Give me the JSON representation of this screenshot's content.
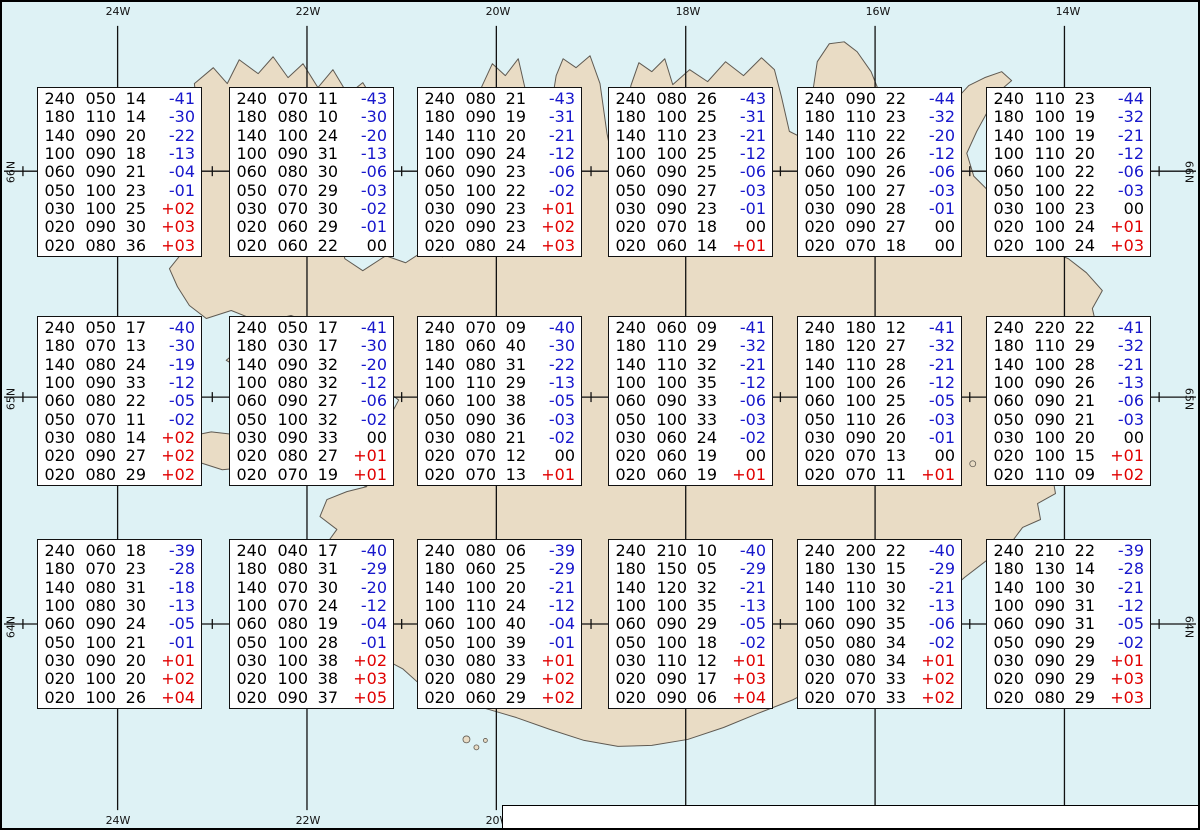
{
  "title": "Spot Chart Iceland",
  "axes": {
    "lon_labels": [
      "24W",
      "22W",
      "20W",
      "18W",
      "16W",
      "14W"
    ],
    "bottom_lon_labels": [
      "24W",
      "22W",
      "20W"
    ],
    "lat_labels": [
      "66N",
      "65N",
      "64N"
    ]
  },
  "footer": {
    "prefix": "Spot Chart: FL Dir KT °C ",
    "source_bold": "UWC/IG-IS:",
    "issue": " IT: Lau. 06. Des. 2025 15Z ",
    "valid_bold": "VT: Lau. 06.12.2025 23Z",
    "suffix": " (+8 h)"
  },
  "colors": {
    "water": "#def2f5",
    "land": "#e9dcc5",
    "coast": "#5f5a52",
    "grid": "#111111",
    "negative_temp": "#1717cc",
    "positive_temp": "#e00000",
    "neutral_temp": "#000000",
    "box_bg": "#ffffff",
    "box_border": "#111111"
  },
  "chart_data": {
    "type": "table",
    "columns": [
      "FL",
      "Dir",
      "KT",
      "°C"
    ],
    "description": "Upper-air spot values (flight level, wind direction deg, wind speed kt, temperature °C) at 18 grid points over Iceland",
    "spots": [
      {
        "lon": "24W",
        "lat": "66N",
        "rows": [
          [
            "240",
            "050",
            "14",
            "-41"
          ],
          [
            "180",
            "110",
            "14",
            "-30"
          ],
          [
            "140",
            "090",
            "20",
            "-22"
          ],
          [
            "100",
            "090",
            "18",
            "-13"
          ],
          [
            "060",
            "090",
            "21",
            "-04"
          ],
          [
            "050",
            "100",
            "23",
            "-01"
          ],
          [
            "030",
            "100",
            "25",
            "+02"
          ],
          [
            "020",
            "090",
            "30",
            "+03"
          ],
          [
            "020",
            "080",
            "36",
            "+03"
          ]
        ]
      },
      {
        "lon": "22W",
        "lat": "66N",
        "rows": [
          [
            "240",
            "070",
            "11",
            "-43"
          ],
          [
            "180",
            "080",
            "10",
            "-30"
          ],
          [
            "140",
            "100",
            "24",
            "-20"
          ],
          [
            "100",
            "090",
            "31",
            "-13"
          ],
          [
            "060",
            "080",
            "30",
            "-06"
          ],
          [
            "050",
            "070",
            "29",
            "-03"
          ],
          [
            "030",
            "070",
            "30",
            "-02"
          ],
          [
            "020",
            "060",
            "29",
            "-01"
          ],
          [
            "020",
            "060",
            "22",
            "00"
          ]
        ]
      },
      {
        "lon": "20W",
        "lat": "66N",
        "rows": [
          [
            "240",
            "080",
            "21",
            "-43"
          ],
          [
            "180",
            "090",
            "19",
            "-31"
          ],
          [
            "140",
            "110",
            "20",
            "-21"
          ],
          [
            "100",
            "090",
            "24",
            "-12"
          ],
          [
            "060",
            "090",
            "23",
            "-06"
          ],
          [
            "050",
            "100",
            "22",
            "-02"
          ],
          [
            "030",
            "090",
            "23",
            "+01"
          ],
          [
            "020",
            "090",
            "23",
            "+02"
          ],
          [
            "020",
            "080",
            "24",
            "+03"
          ]
        ]
      },
      {
        "lon": "18W",
        "lat": "66N",
        "rows": [
          [
            "240",
            "080",
            "26",
            "-43"
          ],
          [
            "180",
            "100",
            "25",
            "-31"
          ],
          [
            "140",
            "110",
            "23",
            "-21"
          ],
          [
            "100",
            "100",
            "25",
            "-12"
          ],
          [
            "060",
            "090",
            "25",
            "-06"
          ],
          [
            "050",
            "090",
            "27",
            "-03"
          ],
          [
            "030",
            "090",
            "23",
            "-01"
          ],
          [
            "020",
            "070",
            "18",
            "00"
          ],
          [
            "020",
            "060",
            "14",
            "+01"
          ]
        ]
      },
      {
        "lon": "16W",
        "lat": "66N",
        "rows": [
          [
            "240",
            "090",
            "22",
            "-44"
          ],
          [
            "180",
            "110",
            "23",
            "-32"
          ],
          [
            "140",
            "110",
            "22",
            "-20"
          ],
          [
            "100",
            "100",
            "26",
            "-12"
          ],
          [
            "060",
            "090",
            "26",
            "-06"
          ],
          [
            "050",
            "100",
            "27",
            "-03"
          ],
          [
            "030",
            "090",
            "28",
            "-01"
          ],
          [
            "020",
            "090",
            "27",
            "00"
          ],
          [
            "020",
            "070",
            "18",
            "00"
          ]
        ]
      },
      {
        "lon": "14W",
        "lat": "66N",
        "rows": [
          [
            "240",
            "110",
            "23",
            "-44"
          ],
          [
            "180",
            "100",
            "19",
            "-32"
          ],
          [
            "140",
            "100",
            "19",
            "-21"
          ],
          [
            "100",
            "110",
            "20",
            "-12"
          ],
          [
            "060",
            "100",
            "22",
            "-06"
          ],
          [
            "050",
            "100",
            "22",
            "-03"
          ],
          [
            "030",
            "100",
            "23",
            "00"
          ],
          [
            "020",
            "100",
            "24",
            "+01"
          ],
          [
            "020",
            "100",
            "24",
            "+03"
          ]
        ]
      },
      {
        "lon": "24W",
        "lat": "65N",
        "rows": [
          [
            "240",
            "050",
            "17",
            "-40"
          ],
          [
            "180",
            "070",
            "13",
            "-30"
          ],
          [
            "140",
            "080",
            "24",
            "-19"
          ],
          [
            "100",
            "090",
            "33",
            "-12"
          ],
          [
            "060",
            "080",
            "22",
            "-05"
          ],
          [
            "050",
            "070",
            "11",
            "-02"
          ],
          [
            "030",
            "080",
            "14",
            "+02"
          ],
          [
            "020",
            "090",
            "27",
            "+02"
          ],
          [
            "020",
            "080",
            "29",
            "+02"
          ]
        ]
      },
      {
        "lon": "22W",
        "lat": "65N",
        "rows": [
          [
            "240",
            "050",
            "17",
            "-41"
          ],
          [
            "180",
            "030",
            "17",
            "-30"
          ],
          [
            "140",
            "090",
            "32",
            "-20"
          ],
          [
            "100",
            "080",
            "32",
            "-12"
          ],
          [
            "060",
            "090",
            "27",
            "-06"
          ],
          [
            "050",
            "100",
            "32",
            "-02"
          ],
          [
            "030",
            "090",
            "33",
            "00"
          ],
          [
            "020",
            "080",
            "27",
            "+01"
          ],
          [
            "020",
            "070",
            "19",
            "+01"
          ]
        ]
      },
      {
        "lon": "20W",
        "lat": "65N",
        "rows": [
          [
            "240",
            "070",
            "09",
            "-40"
          ],
          [
            "180",
            "060",
            "40",
            "-30"
          ],
          [
            "140",
            "080",
            "31",
            "-22"
          ],
          [
            "100",
            "110",
            "29",
            "-13"
          ],
          [
            "060",
            "100",
            "38",
            "-05"
          ],
          [
            "050",
            "090",
            "36",
            "-03"
          ],
          [
            "030",
            "080",
            "21",
            "-02"
          ],
          [
            "020",
            "070",
            "12",
            "00"
          ],
          [
            "020",
            "070",
            "13",
            "+01"
          ]
        ]
      },
      {
        "lon": "18W",
        "lat": "65N",
        "rows": [
          [
            "240",
            "060",
            "09",
            "-41"
          ],
          [
            "180",
            "110",
            "29",
            "-32"
          ],
          [
            "140",
            "110",
            "32",
            "-21"
          ],
          [
            "100",
            "100",
            "35",
            "-12"
          ],
          [
            "060",
            "090",
            "33",
            "-06"
          ],
          [
            "050",
            "100",
            "33",
            "-03"
          ],
          [
            "030",
            "060",
            "24",
            "-02"
          ],
          [
            "020",
            "060",
            "19",
            "00"
          ],
          [
            "020",
            "060",
            "19",
            "+01"
          ]
        ]
      },
      {
        "lon": "16W",
        "lat": "65N",
        "rows": [
          [
            "240",
            "180",
            "12",
            "-41"
          ],
          [
            "180",
            "120",
            "27",
            "-32"
          ],
          [
            "140",
            "110",
            "28",
            "-21"
          ],
          [
            "100",
            "100",
            "26",
            "-12"
          ],
          [
            "060",
            "100",
            "25",
            "-05"
          ],
          [
            "050",
            "110",
            "26",
            "-03"
          ],
          [
            "030",
            "090",
            "20",
            "-01"
          ],
          [
            "020",
            "070",
            "13",
            "00"
          ],
          [
            "020",
            "070",
            "11",
            "+01"
          ]
        ]
      },
      {
        "lon": "14W",
        "lat": "65N",
        "rows": [
          [
            "240",
            "220",
            "22",
            "-41"
          ],
          [
            "180",
            "110",
            "29",
            "-32"
          ],
          [
            "140",
            "100",
            "28",
            "-21"
          ],
          [
            "100",
            "090",
            "26",
            "-13"
          ],
          [
            "060",
            "090",
            "21",
            "-06"
          ],
          [
            "050",
            "090",
            "21",
            "-03"
          ],
          [
            "030",
            "100",
            "20",
            "00"
          ],
          [
            "020",
            "100",
            "15",
            "+01"
          ],
          [
            "020",
            "110",
            "09",
            "+02"
          ]
        ]
      },
      {
        "lon": "24W",
        "lat": "64N",
        "rows": [
          [
            "240",
            "060",
            "18",
            "-39"
          ],
          [
            "180",
            "070",
            "23",
            "-28"
          ],
          [
            "140",
            "080",
            "31",
            "-18"
          ],
          [
            "100",
            "080",
            "30",
            "-13"
          ],
          [
            "060",
            "090",
            "24",
            "-05"
          ],
          [
            "050",
            "100",
            "21",
            "-01"
          ],
          [
            "030",
            "090",
            "20",
            "+01"
          ],
          [
            "020",
            "100",
            "20",
            "+02"
          ],
          [
            "020",
            "100",
            "26",
            "+04"
          ]
        ]
      },
      {
        "lon": "22W",
        "lat": "64N",
        "rows": [
          [
            "240",
            "040",
            "17",
            "-40"
          ],
          [
            "180",
            "080",
            "31",
            "-29"
          ],
          [
            "140",
            "070",
            "30",
            "-20"
          ],
          [
            "100",
            "070",
            "24",
            "-12"
          ],
          [
            "060",
            "080",
            "19",
            "-04"
          ],
          [
            "050",
            "100",
            "28",
            "-01"
          ],
          [
            "030",
            "100",
            "38",
            "+02"
          ],
          [
            "020",
            "100",
            "38",
            "+03"
          ],
          [
            "020",
            "090",
            "37",
            "+05"
          ]
        ]
      },
      {
        "lon": "20W",
        "lat": "64N",
        "rows": [
          [
            "240",
            "080",
            "06",
            "-39"
          ],
          [
            "180",
            "060",
            "25",
            "-29"
          ],
          [
            "140",
            "100",
            "20",
            "-21"
          ],
          [
            "100",
            "110",
            "24",
            "-12"
          ],
          [
            "060",
            "100",
            "40",
            "-04"
          ],
          [
            "050",
            "100",
            "39",
            "-01"
          ],
          [
            "030",
            "080",
            "33",
            "+01"
          ],
          [
            "020",
            "080",
            "29",
            "+02"
          ],
          [
            "020",
            "060",
            "29",
            "+02"
          ]
        ]
      },
      {
        "lon": "18W",
        "lat": "64N",
        "rows": [
          [
            "240",
            "210",
            "10",
            "-40"
          ],
          [
            "180",
            "150",
            "05",
            "-29"
          ],
          [
            "140",
            "120",
            "32",
            "-21"
          ],
          [
            "100",
            "100",
            "35",
            "-13"
          ],
          [
            "060",
            "090",
            "29",
            "-05"
          ],
          [
            "050",
            "100",
            "18",
            "-02"
          ],
          [
            "030",
            "110",
            "12",
            "+01"
          ],
          [
            "020",
            "090",
            "17",
            "+03"
          ],
          [
            "020",
            "090",
            "06",
            "+04"
          ]
        ]
      },
      {
        "lon": "16W",
        "lat": "64N",
        "rows": [
          [
            "240",
            "200",
            "22",
            "-40"
          ],
          [
            "180",
            "130",
            "15",
            "-29"
          ],
          [
            "140",
            "110",
            "30",
            "-21"
          ],
          [
            "100",
            "100",
            "32",
            "-13"
          ],
          [
            "060",
            "090",
            "35",
            "-06"
          ],
          [
            "050",
            "080",
            "34",
            "-02"
          ],
          [
            "030",
            "080",
            "34",
            "+01"
          ],
          [
            "020",
            "070",
            "33",
            "+02"
          ],
          [
            "020",
            "070",
            "33",
            "+02"
          ]
        ]
      },
      {
        "lon": "14W",
        "lat": "64N",
        "rows": [
          [
            "240",
            "210",
            "22",
            "-39"
          ],
          [
            "180",
            "130",
            "14",
            "-28"
          ],
          [
            "140",
            "100",
            "30",
            "-21"
          ],
          [
            "100",
            "090",
            "31",
            "-12"
          ],
          [
            "060",
            "090",
            "31",
            "-05"
          ],
          [
            "050",
            "090",
            "29",
            "-02"
          ],
          [
            "030",
            "090",
            "29",
            "+01"
          ],
          [
            "020",
            "090",
            "29",
            "+03"
          ],
          [
            "020",
            "080",
            "29",
            "+03"
          ]
        ]
      }
    ]
  }
}
